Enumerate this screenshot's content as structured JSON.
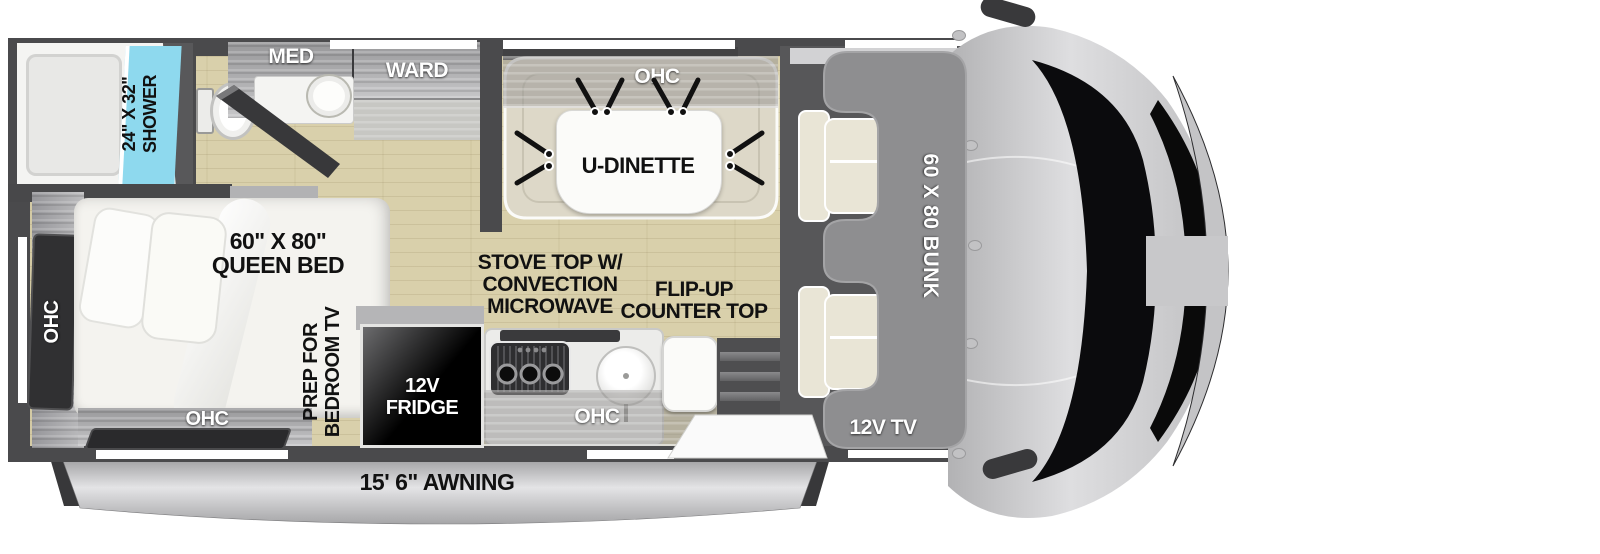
{
  "colors": {
    "wall": "#4a4a4c",
    "floor_wood": "#d9d0ab",
    "shower_glass_blue": "#8ed9ee",
    "cabinet_gray": "#a8a8aa",
    "dark_panel": "#303032",
    "bunk_gray": "#8e8e90",
    "cab_body_gray": "#c8c8ca",
    "awning_silver": "#c6c6c8",
    "label_dark": "#111111",
    "label_light": "#ffffff"
  },
  "bathroom": {
    "shower_size": "24\" X 32\"",
    "shower_name": "SHOWER",
    "medicine_cabinet": "MED",
    "wardrobe": "WARD"
  },
  "dinette": {
    "overhead_cabinet": "OHC",
    "name": "U-DINETTE"
  },
  "bedroom": {
    "side_overhead_cabinet": "OHC",
    "bed_size": "60\" X 80\"",
    "bed_name": "QUEEN BED",
    "foot_overhead_cabinet": "OHC",
    "tv_prep_line1": "PREP FOR",
    "tv_prep_line2": "BEDROOM TV"
  },
  "kitchen": {
    "fridge_line1": "12V",
    "fridge_line2": "FRIDGE",
    "stove_line1": "STOVE TOP W/",
    "stove_line2": "CONVECTION",
    "stove_line3": "MICROWAVE",
    "flip_counter_line1": "FLIP-UP",
    "flip_counter_line2": "COUNTER TOP",
    "overhead_cabinet": "OHC"
  },
  "cab": {
    "bunk_size": "60 X 80 BUNK",
    "tv": "12V TV"
  },
  "exterior": {
    "awning": "15' 6\" AWNING"
  }
}
